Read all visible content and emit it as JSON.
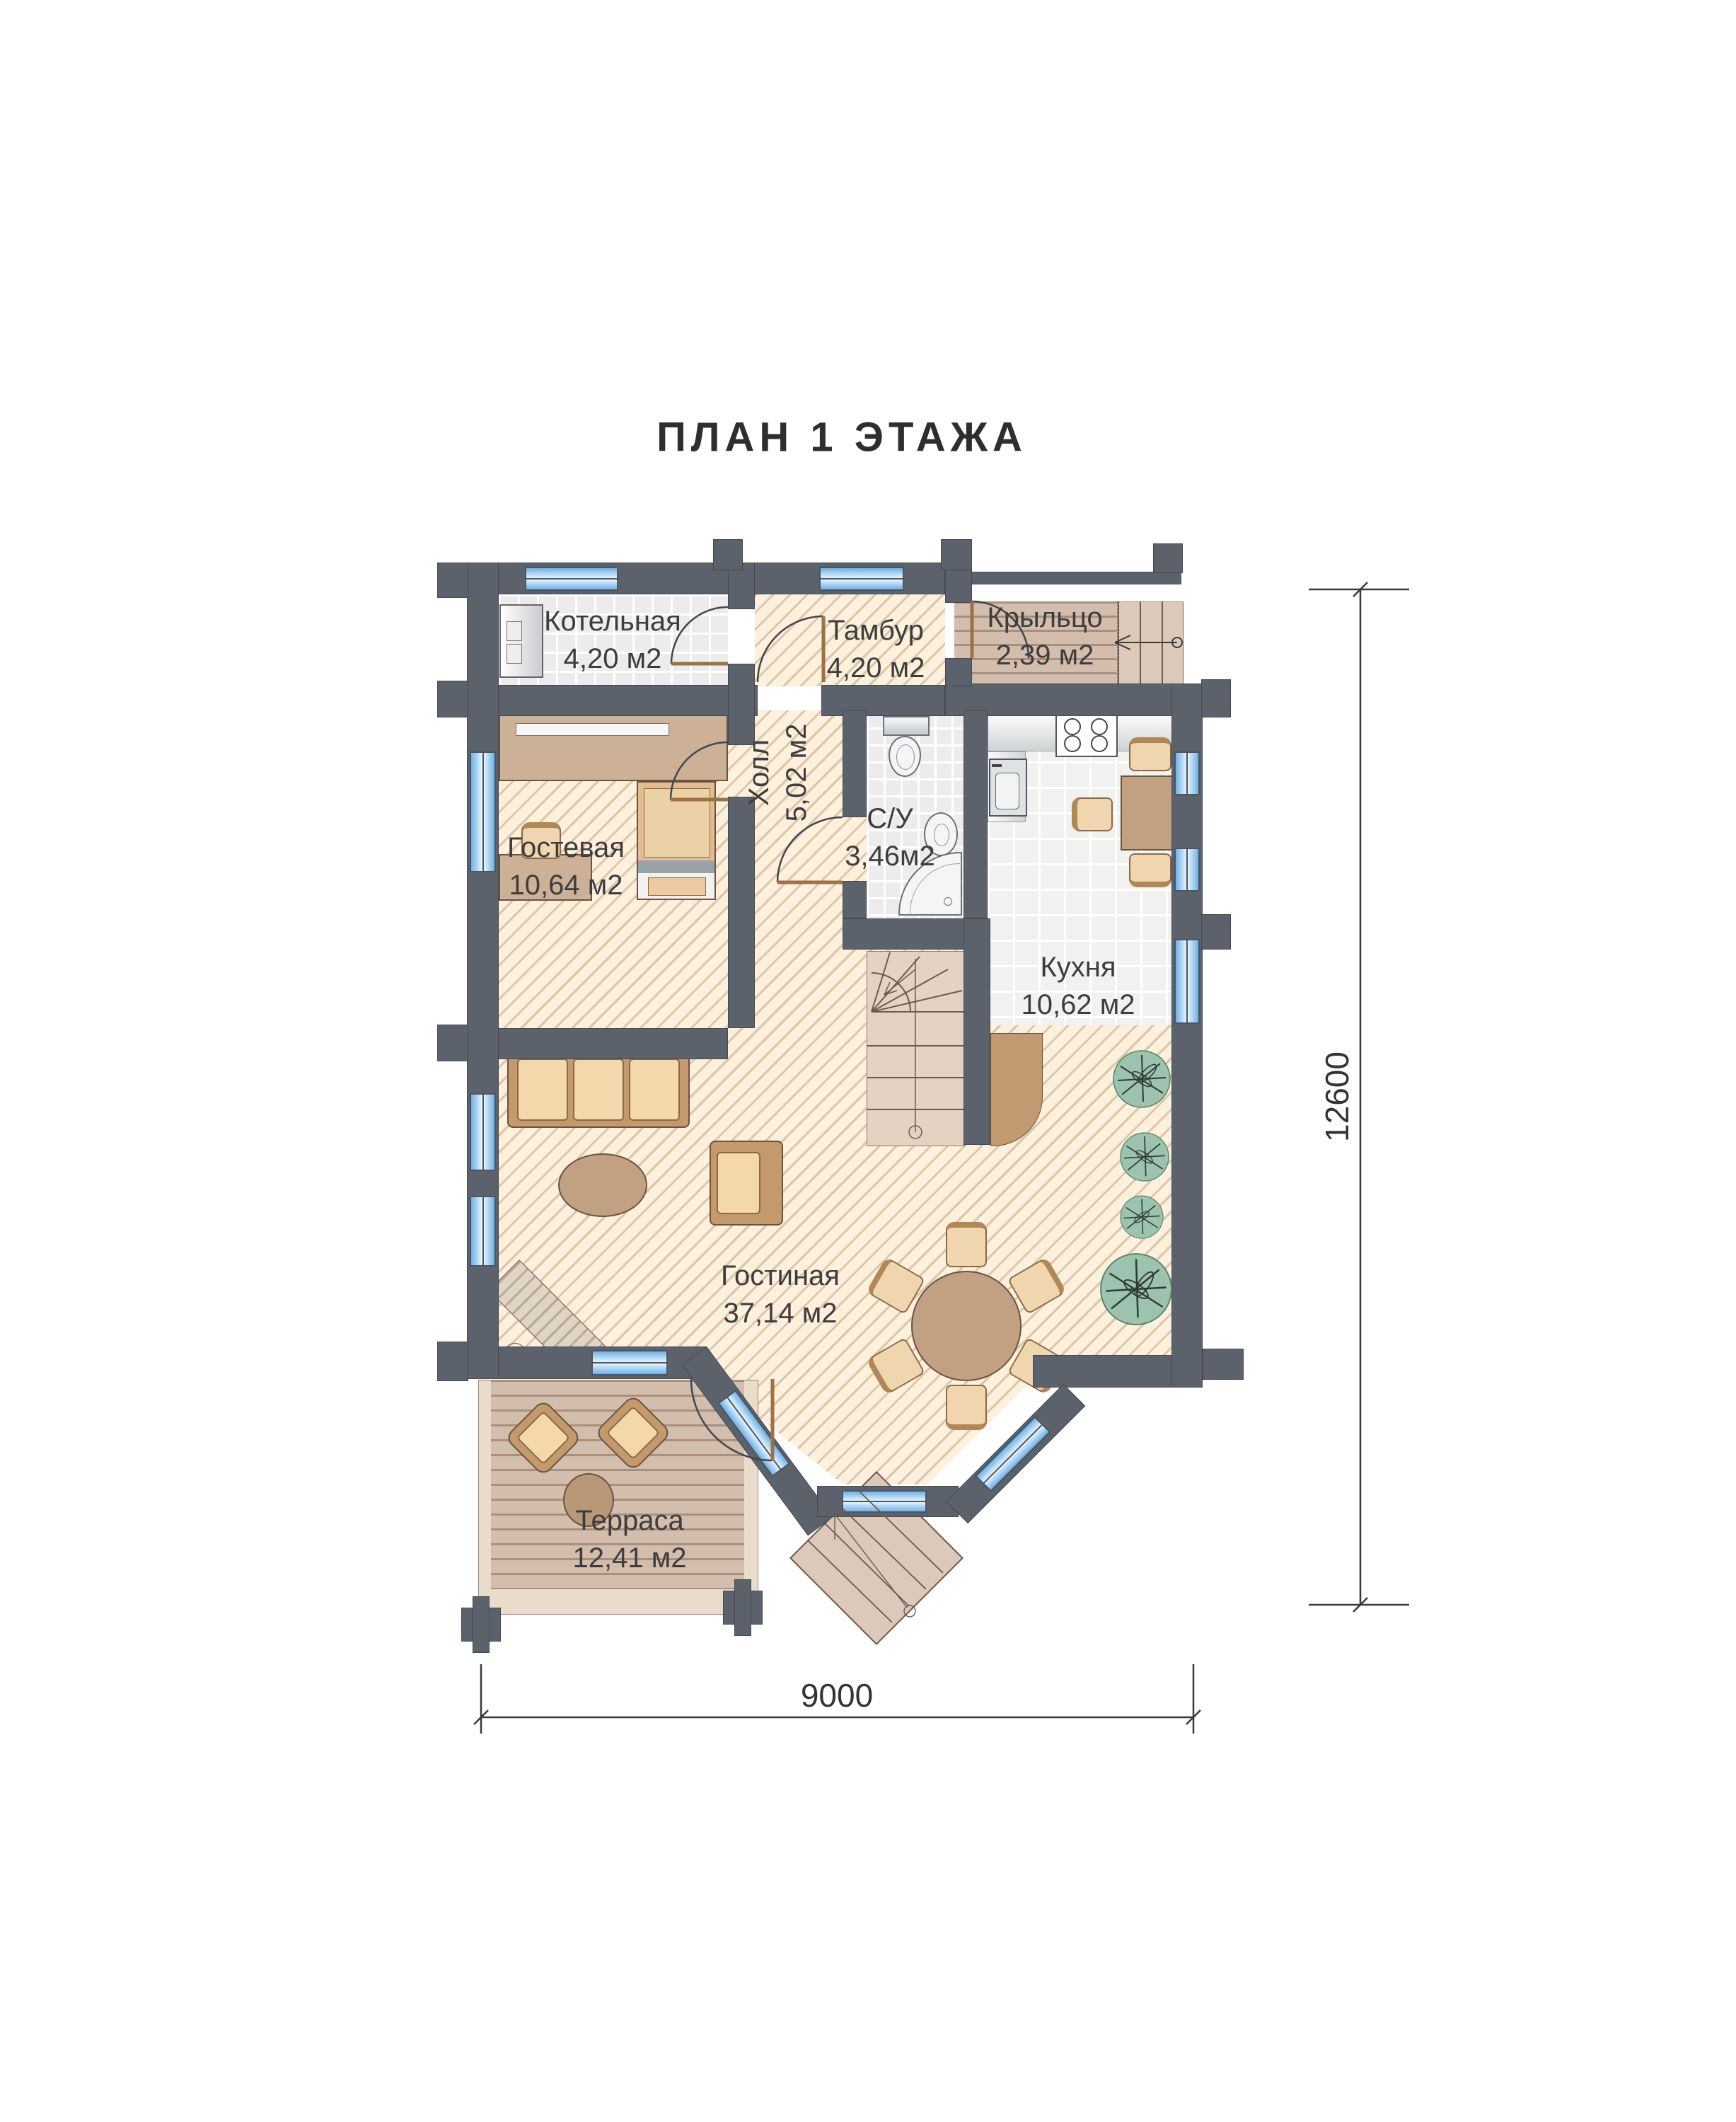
{
  "title": "ПЛАН 1 ЭТАЖА",
  "rooms": {
    "boiler": {
      "name": "Котельная",
      "area": "4,20 м2"
    },
    "vestibule": {
      "name": "Тамбур",
      "area": "4,20 м2"
    },
    "porch": {
      "name": "Крыльцо",
      "area": "2,39 м2"
    },
    "hall": {
      "name": "Холл",
      "area": "5,02 м2"
    },
    "bathroom": {
      "name": "С/У",
      "area": "3,46м2"
    },
    "kitchen": {
      "name": "Кухня",
      "area": "10,62 м2"
    },
    "guest": {
      "name": "Гостевая",
      "area": "10,64 м2"
    },
    "living": {
      "name": "Гостиная",
      "area": "37,14 м2"
    },
    "terrace": {
      "name": "Терраса",
      "area": "12,41 м2"
    }
  },
  "dimensions": {
    "vertical": "12600",
    "horizontal": "9000"
  },
  "icons": {
    "sofa-icon": "css-shape",
    "armchair-icon": "css-shape",
    "coffee-table-icon": "css-ellipse",
    "fireplace-icon": "css-shape",
    "dining-table-icon": "css-circle",
    "chair-icon": "css-shape",
    "plant-icon": "svg",
    "bed-icon": "css-shape",
    "desk-icon": "css-shape",
    "wardrobe-icon": "css-shape",
    "boiler-icon": "css-shape",
    "toilet-icon": "css-shape",
    "sink-icon": "css-shape",
    "shower-icon": "css-shape",
    "stove-icon": "css-shape",
    "stairs-icon": "svg",
    "entry-steps-icon": "css-shape",
    "door-arc": "svg"
  },
  "colors": {
    "wall": "#5b626b",
    "hatch_floor": "#fdf0dc",
    "hatch_stripe": "#dcc6a8",
    "tile": "#ececec",
    "wood": "#d3bead",
    "window": "#6fb0e4",
    "furniture": "#c49a6c",
    "cushion": "#f3d8ac",
    "plant": "#9cc3ad",
    "label": "#3d3d3d"
  }
}
